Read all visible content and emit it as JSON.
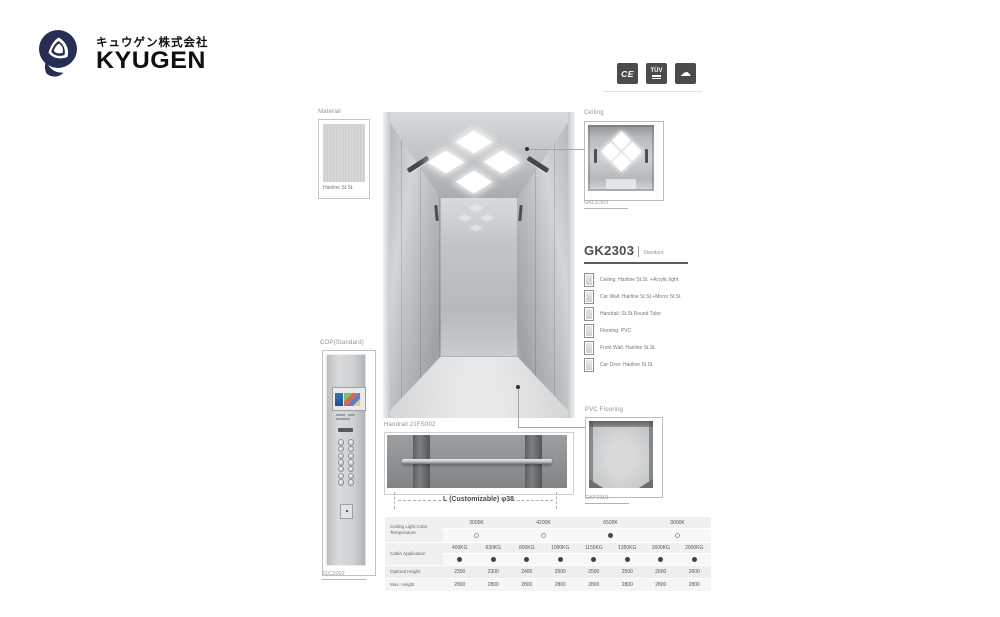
{
  "brand": {
    "company_jp": "キュウゲン株式会社",
    "company_en": "KYUGEN"
  },
  "certifications": {
    "ce": "CE",
    "tuv": "TÜV",
    "cloud_icon": "☁"
  },
  "material_card": {
    "caption": "Material",
    "name": "Hairline St.St."
  },
  "ceiling_card": {
    "caption": "Ceiling",
    "model": "GKD2303"
  },
  "product": {
    "model": "GK2303",
    "grade": "Standard",
    "specs": [
      "Ceiling: Hairline St.St. +Acrylic light",
      "Car Wall: Hairline St.St.+Mirror St.St.",
      "Handrail: St.St.Round Tube",
      "Flooring: PVC",
      "Front Wall: Hairline St.St.",
      "Car Door: Hairline St.St."
    ]
  },
  "cop_card": {
    "caption": "COP(Standard)",
    "model": "21CZ002"
  },
  "handrail_card": {
    "caption": "Handrail 21FS002",
    "dimension": "L (Customizable)  φ38"
  },
  "flooring_card": {
    "caption": "PVC Flooring",
    "model": "GKP2301"
  },
  "spec_table": {
    "temperature": {
      "label": "Ceiling Light Color Temperature",
      "options": [
        {
          "label": "3000K",
          "selected": false
        },
        {
          "label": "4200K",
          "selected": false
        },
        {
          "label": "6500K",
          "selected": true
        },
        {
          "label": "9000K",
          "selected": false
        }
      ]
    },
    "application": {
      "label": "Cabin Application",
      "options": [
        {
          "label": "400KG",
          "selected": true
        },
        {
          "label": "630KG",
          "selected": true
        },
        {
          "label": "800KG",
          "selected": true
        },
        {
          "label": "1000KG",
          "selected": true
        },
        {
          "label": "1150KG",
          "selected": true
        },
        {
          "label": "1350KG",
          "selected": true
        },
        {
          "label": "1600KG",
          "selected": true
        },
        {
          "label": "2000KG",
          "selected": true
        }
      ]
    },
    "optimal_height": {
      "label": "Optimal Height",
      "values": [
        "2300",
        "2300",
        "2400",
        "2500",
        "2500",
        "2500",
        "2600",
        "2600"
      ]
    },
    "max_height": {
      "label": "Max. Height",
      "values": [
        "2800",
        "2800",
        "2800",
        "2800",
        "2800",
        "2800",
        "2800",
        "2800"
      ]
    }
  },
  "colors": {
    "logo_navy": "#262e55",
    "cert_badge_bg": "#4b4b4b",
    "selected_dot": "#4a4a4a"
  }
}
